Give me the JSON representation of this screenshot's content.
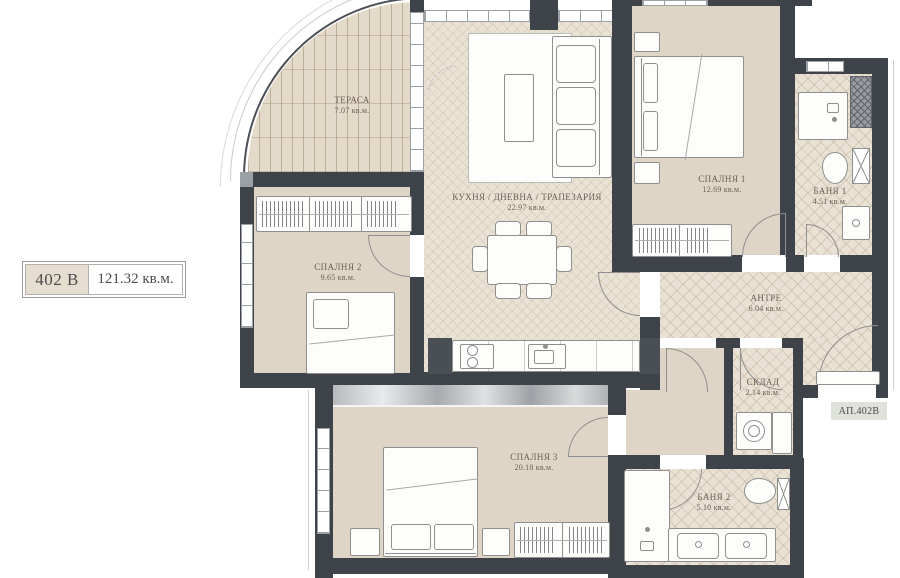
{
  "meta": {
    "apartment_label": "402 B",
    "apartment_area": "121.32 кв.м.",
    "apartment_tag": "АП.402В"
  },
  "rooms": [
    {
      "id": "terrace",
      "name": "ТЕРАСА",
      "area": "7.07 кв.м."
    },
    {
      "id": "kitchen",
      "name": "КУХНЯ / ДНЕВНА / ТРАПЕЗАРИЯ",
      "area": "22.97 кв.м."
    },
    {
      "id": "bedroom1",
      "name": "СПАЛНЯ 1",
      "area": "12.69 кв.м."
    },
    {
      "id": "bath1",
      "name": "БАНЯ 1",
      "area": "4.51 кв.м."
    },
    {
      "id": "bedroom2",
      "name": "СПАЛНЯ 2",
      "area": "9.65 кв.м."
    },
    {
      "id": "hall",
      "name": "АНТРЕ",
      "area": "6.04 кв.м."
    },
    {
      "id": "storage",
      "name": "СКЛАД",
      "area": "2.14 кв.м."
    },
    {
      "id": "bedroom3",
      "name": "СПАЛНЯ 3",
      "area": "20.18 кв.м."
    },
    {
      "id": "bath2",
      "name": "БАНЯ 2",
      "area": "5.10 кв.м."
    }
  ],
  "colors": {
    "wall": "#3e434a",
    "floor_beige": "#ded5c6",
    "floor_tile": "#e9e1d3",
    "floor_herringbone": "#eae3d5",
    "terrace_deck": "#e4dac9",
    "label_cell_bg": "#e5ddd0",
    "tag_bg": "#dfe2da",
    "label_text": "#6b6156"
  }
}
